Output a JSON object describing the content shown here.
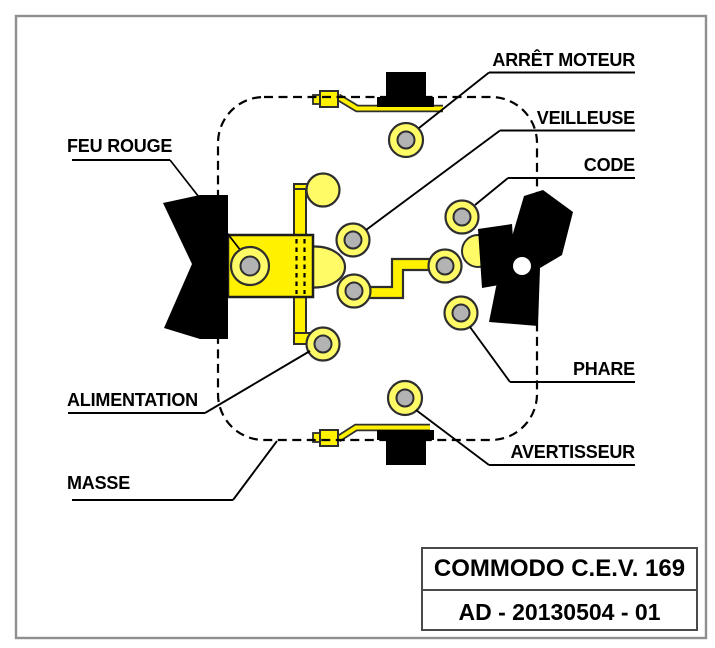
{
  "page": {
    "background": "#ffffff",
    "frame_color": "#8f8f8f"
  },
  "diagram": {
    "description": "wiring-diagram-of-handlebar-switch",
    "colors": {
      "bright_yellow": "#ffF100",
      "light_yellow": "#fffb66",
      "terminal_gray": "#b3b3b3",
      "outline": "#2e2e2e",
      "black_part": "#000000"
    },
    "labels": {
      "feu_rouge": "FEU ROUGE",
      "arret_moteur": "ARRÊT MOTEUR",
      "veilleuse": "VEILLEUSE",
      "code": "CODE",
      "phare": "PHARE",
      "avertisseur": "AVERTISSEUR",
      "alimentation": "ALIMENTATION",
      "masse": "MASSE"
    }
  },
  "title_block": {
    "line1": "COMMODO C.E.V. 169",
    "line2": "AD - 20130504 - 01"
  }
}
